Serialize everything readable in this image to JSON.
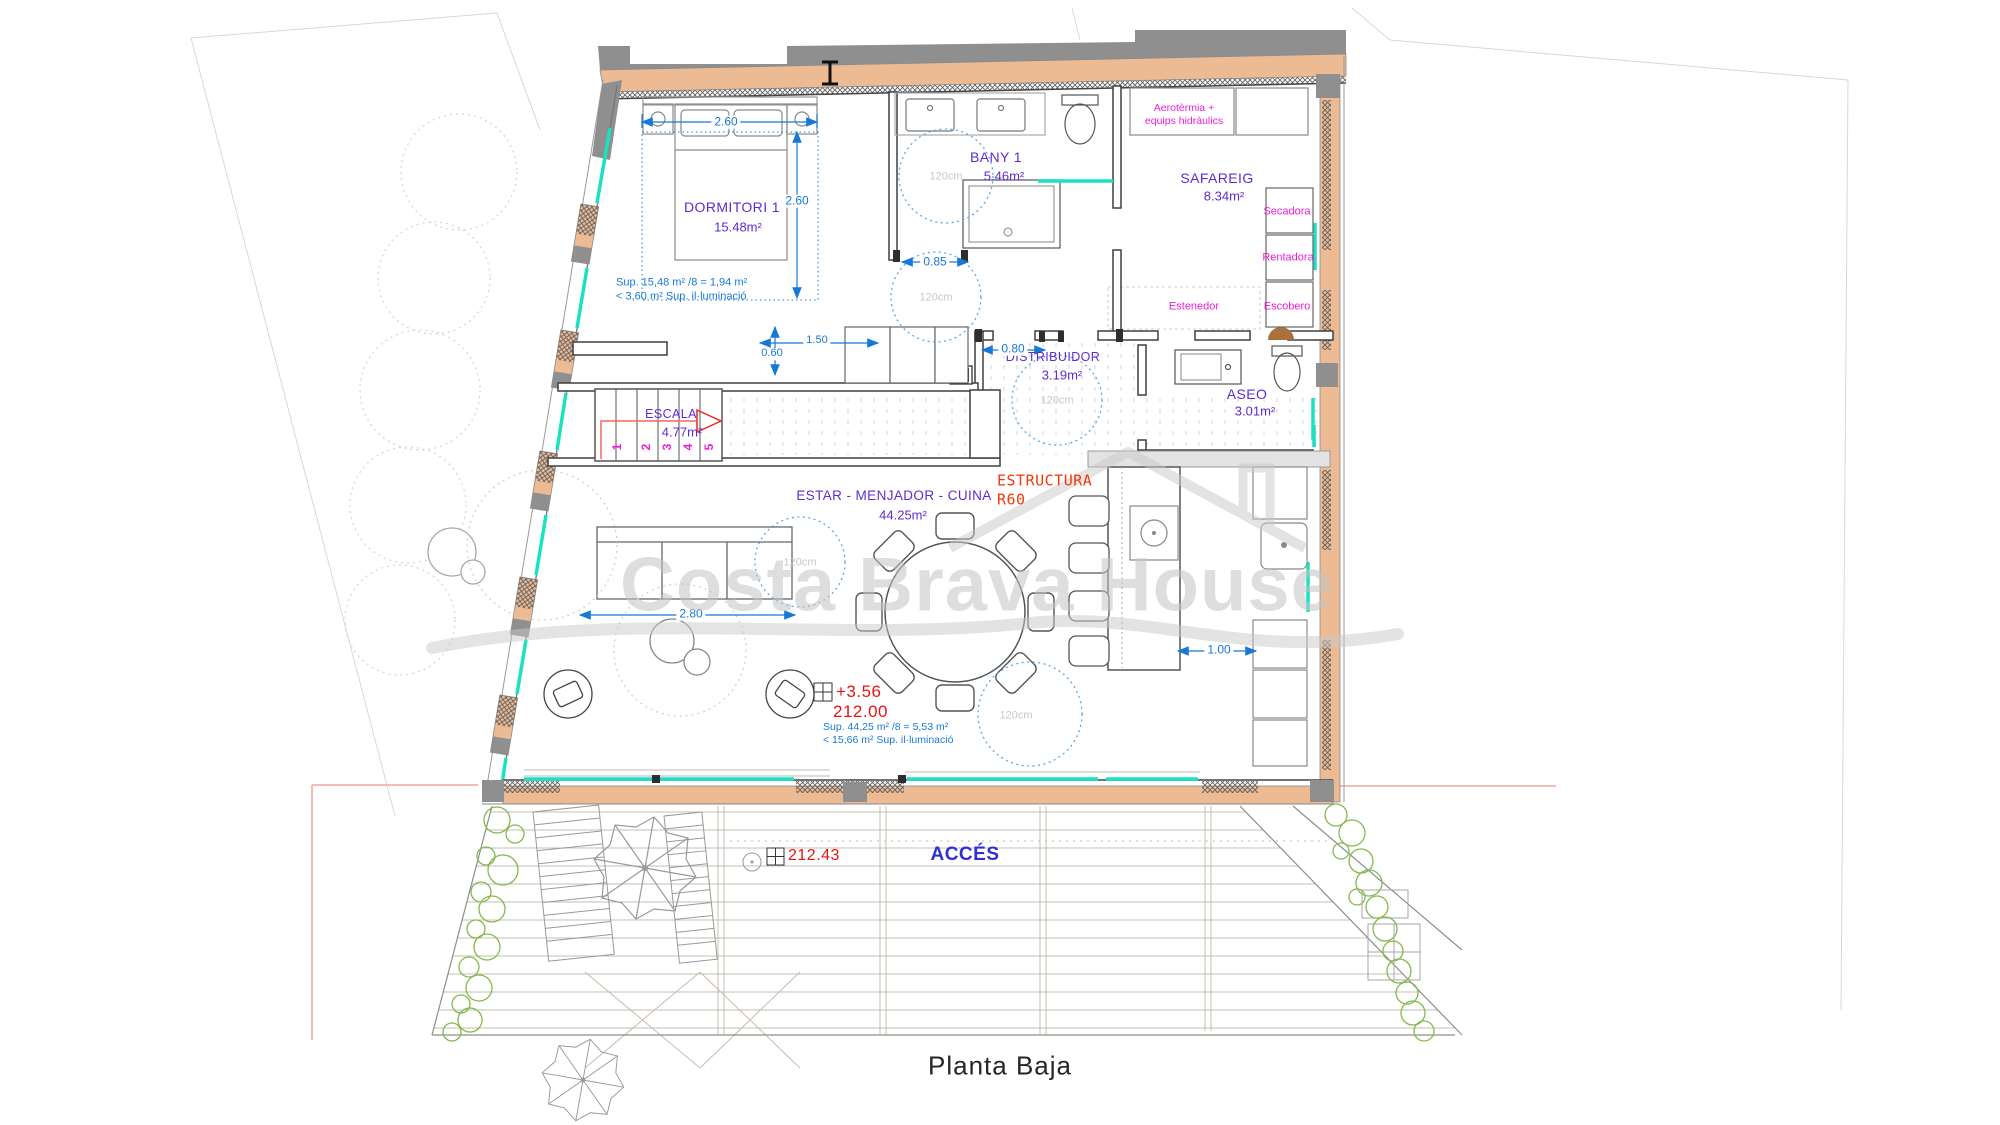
{
  "plan": {
    "title": "Planta Baja",
    "watermark": "Costa Brava House",
    "access_label": "ACCÉS",
    "turning_circle_label": "120cm",
    "rooms": {
      "dormitori": {
        "name": "DORMITORI 1",
        "area": "15.48m²",
        "note1": "Sup. 15,48 m² /8 = 1,94 m²",
        "note2": "< 3,60 m² Sup. il·luminació"
      },
      "bany": {
        "name": "BANY 1",
        "area": "5.46m²"
      },
      "safareig": {
        "name": "SAFAREIG",
        "area": "8.34m²"
      },
      "distribuidor": {
        "name": "DISTRIBUIDOR",
        "area": "3.19m²"
      },
      "aseo": {
        "name": "ASEO",
        "area": "3.01m²"
      },
      "escala": {
        "name": "ESCALA",
        "area": "4.77m²",
        "steps": [
          "1",
          "2",
          "3",
          "4",
          "5"
        ]
      },
      "estar": {
        "name": "ESTAR - MENJADOR - CUINA",
        "area": "44.25m²",
        "note1": "Sup. 44,25 m² /8 = 5,53 m²",
        "note2": "< 15,66 m² Sup. il·luminació"
      }
    },
    "equipment": {
      "aerotermia_line1": "Aerotèrmia +",
      "aerotermia_line2": "equips hidràulics",
      "secadora": "Secadora",
      "rentadora": "Rentadora",
      "estenedor": "Estenedor",
      "escobero": "Escobero"
    },
    "structure": {
      "line1": "ESTRUCTURA",
      "line2": "R60"
    },
    "levels": {
      "relative": "+3.56",
      "absolute": "212.00",
      "terrace": "212.43"
    },
    "dimensions": {
      "bed_width": "2.60",
      "room_depth": "2.60",
      "bany_door": "0.85",
      "closet_width": "1.50",
      "closet_depth": "0.60",
      "distribuidor_door": "0.80",
      "sofa_zone": "2.80",
      "kitchen_aisle": "1.00"
    },
    "colors": {
      "wall_fill": "#ecba93",
      "glazing": "#19e2c2",
      "room_label": "#5e2bd1",
      "equipment_label": "#ee1ed8",
      "dimension": "#1779d6",
      "level_red": "#e81414",
      "structure_red": "#f4380b",
      "access_blue": "#2f2fd3"
    }
  }
}
